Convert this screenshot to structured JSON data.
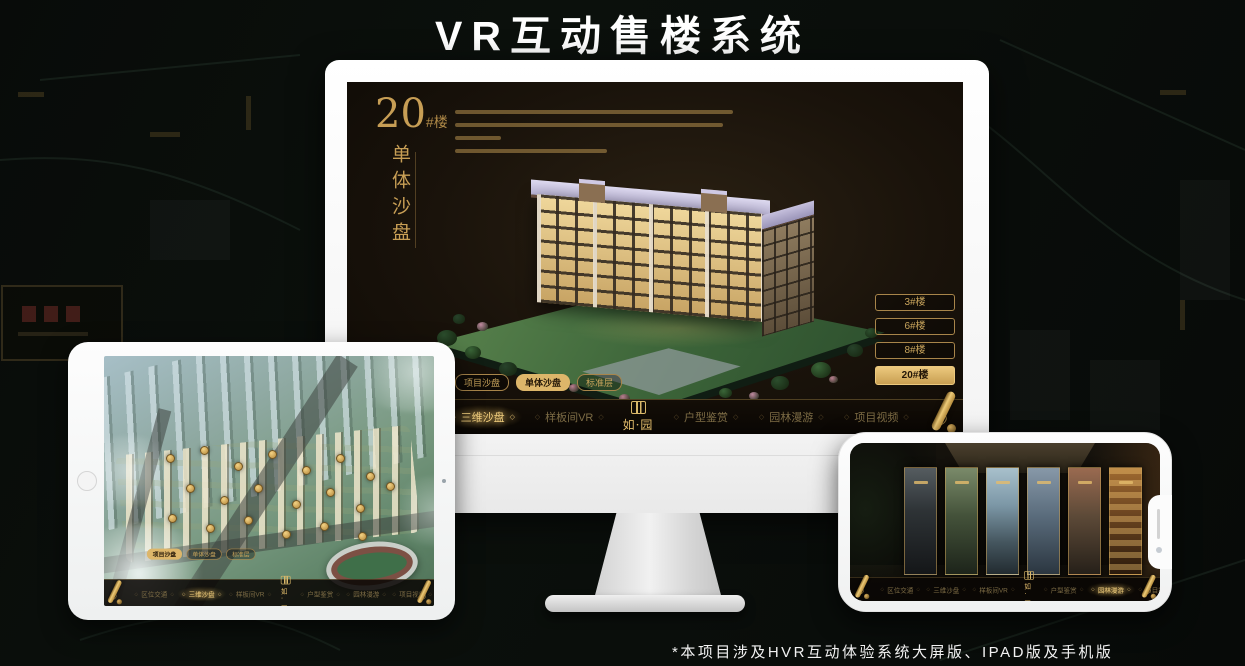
{
  "page": {
    "title": "VR互动售楼系统",
    "footnote": "*本项目涉及HVR互动体验系统大屏版、IPAD版及手机版"
  },
  "brand": {
    "logo_text": "如·园"
  },
  "colors": {
    "gold_accent": "#ddb66a",
    "screen_background": "#16100a",
    "selected_text": "#eecb7c"
  },
  "desktop": {
    "hero": {
      "number": "20",
      "suffix": "#楼",
      "vertical_title": "单体沙盘"
    },
    "floor_buttons": [
      {
        "label": "3#楼",
        "selected": false
      },
      {
        "label": "6#楼",
        "selected": false
      },
      {
        "label": "8#楼",
        "selected": false
      },
      {
        "label": "20#楼",
        "selected": true
      }
    ],
    "view_tabs": [
      {
        "label": "项目沙盘",
        "selected": false
      },
      {
        "label": "单体沙盘",
        "selected": true
      },
      {
        "label": "标准层",
        "selected": false
      }
    ],
    "nav_left": [
      {
        "label": "区位交通",
        "selected": false
      },
      {
        "label": "三维沙盘",
        "selected": true
      },
      {
        "label": "样板间VR",
        "selected": false
      }
    ],
    "nav_right": [
      {
        "label": "户型鉴赏",
        "selected": false
      },
      {
        "label": "园林漫游",
        "selected": false
      },
      {
        "label": "项目视频",
        "selected": false
      }
    ]
  },
  "tablet": {
    "view_tabs": [
      {
        "label": "项目沙盘",
        "selected": true
      },
      {
        "label": "单体沙盘",
        "selected": false
      },
      {
        "label": "标准层",
        "selected": false
      }
    ],
    "nav_left": [
      {
        "label": "区位交通",
        "selected": false
      },
      {
        "label": "三维沙盘",
        "selected": true
      },
      {
        "label": "样板间VR",
        "selected": false
      }
    ],
    "nav_right": [
      {
        "label": "户型鉴赏",
        "selected": false
      },
      {
        "label": "园林漫游",
        "selected": false
      },
      {
        "label": "项目视频",
        "selected": false
      }
    ]
  },
  "phone": {
    "nav_left": [
      {
        "label": "区位交通",
        "selected": false
      },
      {
        "label": "三维沙盘",
        "selected": false
      },
      {
        "label": "样板间VR",
        "selected": false
      }
    ],
    "nav_right": [
      {
        "label": "户型鉴赏",
        "selected": false
      },
      {
        "label": "园林漫游",
        "selected": true
      },
      {
        "label": "项目视频",
        "selected": false
      }
    ]
  }
}
